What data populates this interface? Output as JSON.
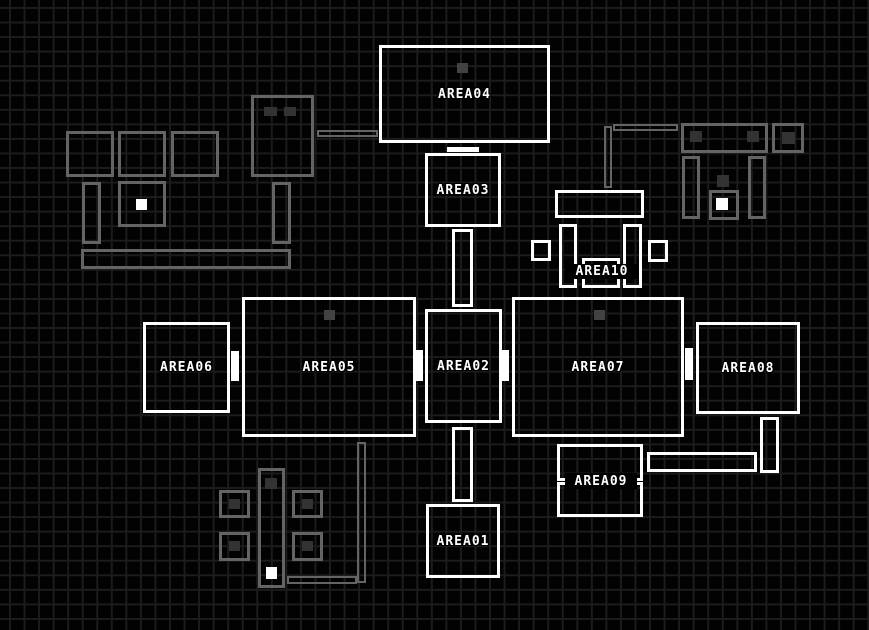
{
  "map": {
    "colors": {
      "background": "#020202",
      "grid_line": "#1c1c1c",
      "room_outline": "#ffffff",
      "door_fill": "#ffffff",
      "furniture_outline": "#646464",
      "marker_fill": "#424242",
      "highlight_fill": "#ffffff"
    },
    "rooms": {
      "area01": {
        "label": "AREA01"
      },
      "area02": {
        "label": "AREA02"
      },
      "area03": {
        "label": "AREA03"
      },
      "area04": {
        "label": "AREA04"
      },
      "area05": {
        "label": "AREA05"
      },
      "area06": {
        "label": "AREA06"
      },
      "area07": {
        "label": "AREA07"
      },
      "area08": {
        "label": "AREA08"
      },
      "area09": {
        "label": "AREA09"
      },
      "area10": {
        "label": "AREA10"
      }
    }
  }
}
